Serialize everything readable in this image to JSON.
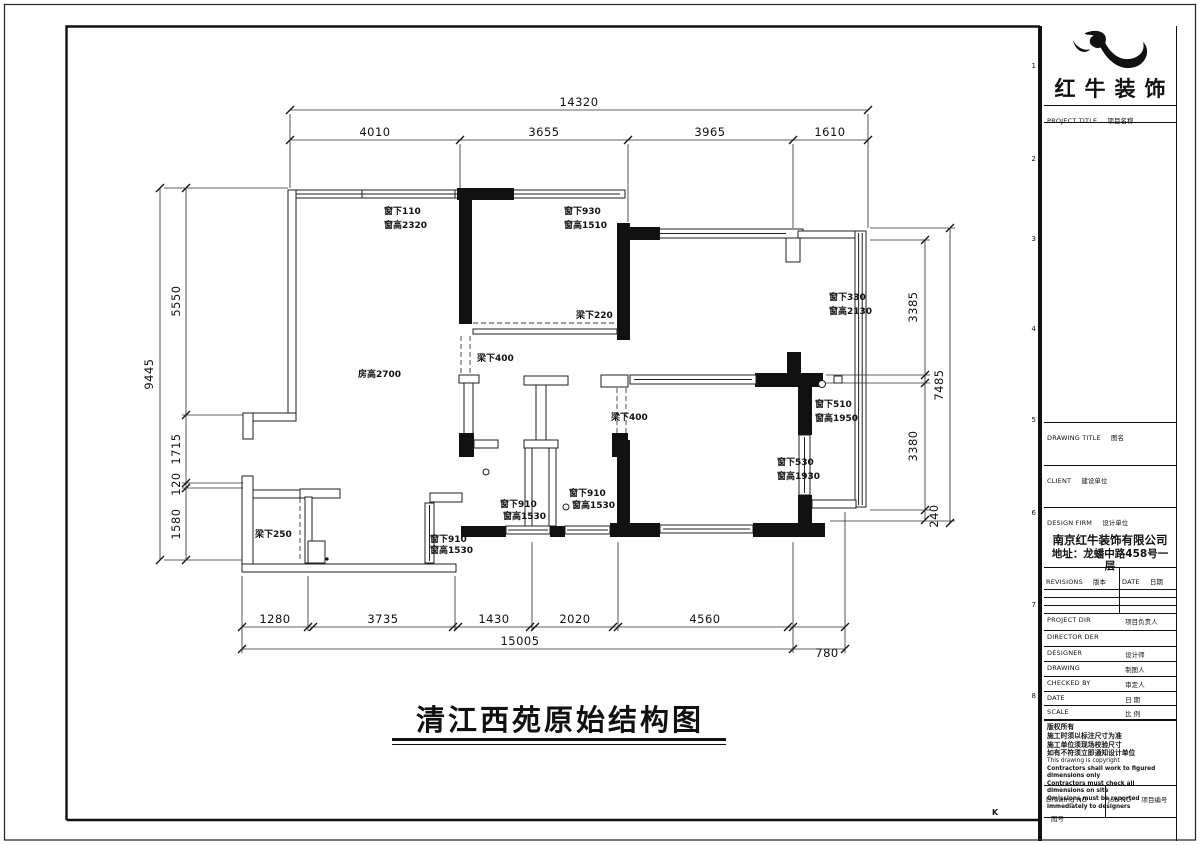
{
  "page": {
    "main_title": "清江西苑原始结构图",
    "corner_mark": "K",
    "grid_numbers": [
      "1",
      "2",
      "3",
      "4",
      "5",
      "6",
      "7",
      "8"
    ]
  },
  "title_block": {
    "logo_text": "红牛装饰",
    "project_title": {
      "en": "PROJECT TITLE",
      "cn": "项目名称"
    },
    "drawing_title": {
      "en": "DRAWING TITLE",
      "cn": "图名"
    },
    "client": {
      "en": "CLIENT",
      "cn": "建设单位"
    },
    "design_firm": {
      "en": "DESIGN FIRM",
      "cn": "设计单位"
    },
    "firm_name": "南京红牛装饰有限公司",
    "firm_address": "地址：龙蟠中路458号一层",
    "revisions": {
      "en": "REVISIONS",
      "cn": "版本"
    },
    "date_col": {
      "en": "DATE",
      "cn": "日期"
    },
    "project_dir": {
      "en": "PROJECT DIR",
      "cn": "项目负责人"
    },
    "director": {
      "en": "DIRECTOR DER",
      "cn": ""
    },
    "designer": {
      "en": "DESIGNER",
      "cn": "设计师"
    },
    "drawing": {
      "en": "DRAWING",
      "cn": "制图人"
    },
    "checked_by": {
      "en": "CHECKED BY",
      "cn": "审定人"
    },
    "date_row": {
      "en": "DATE",
      "cn": "日 期"
    },
    "scale": {
      "en": "SCALE",
      "cn": "比 例"
    },
    "notes_cn": [
      "版权所有",
      "施工时须以标注尺寸为准",
      "施工单位须现场校验尺寸",
      "如有不符须立即通知设计单位"
    ],
    "notes_en": [
      "This drawing is copyright"
    ],
    "notes_en_bold": [
      "Contractors shall work to figured dimensions only",
      "Contractors must check all dimensions on site",
      "Omissions must be reported immediately to designers"
    ],
    "drawing_no": {
      "en": "Drawing NO",
      "cn": "图号"
    },
    "job_no": {
      "en": "Job NO",
      "cn": "项目编号"
    }
  },
  "plan": {
    "annotations": [
      {
        "t": "窗下110",
        "x": 384,
        "y": 214
      },
      {
        "t": "窗高2320",
        "x": 384,
        "y": 228
      },
      {
        "t": "窗下930",
        "x": 564,
        "y": 214
      },
      {
        "t": "窗高1510",
        "x": 564,
        "y": 228
      },
      {
        "t": "梁下220",
        "x": 576,
        "y": 318
      },
      {
        "t": "梁下400",
        "x": 477,
        "y": 361
      },
      {
        "t": "房高2700",
        "x": 358,
        "y": 377
      },
      {
        "t": "窗下330",
        "x": 829,
        "y": 300
      },
      {
        "t": "窗高2130",
        "x": 829,
        "y": 314
      },
      {
        "t": "窗下510",
        "x": 815,
        "y": 407
      },
      {
        "t": "窗高1950",
        "x": 815,
        "y": 421
      },
      {
        "t": "窗下530",
        "x": 777,
        "y": 465
      },
      {
        "t": "窗高1930",
        "x": 777,
        "y": 479
      },
      {
        "t": "梁下400",
        "x": 611,
        "y": 420
      },
      {
        "t": "窗下910",
        "x": 500,
        "y": 507
      },
      {
        "t": "窗高1530",
        "x": 503,
        "y": 519
      },
      {
        "t": "窗下910",
        "x": 569,
        "y": 496
      },
      {
        "t": "窗高1530",
        "x": 572,
        "y": 508
      },
      {
        "t": "窗下910",
        "x": 430,
        "y": 542
      },
      {
        "t": "窗高1530",
        "x": 430,
        "y": 553
      },
      {
        "t": "梁下250",
        "x": 255,
        "y": 537
      }
    ],
    "dimensions": [
      {
        "t": "14320",
        "x": 579,
        "y": 106
      },
      {
        "t": "4010",
        "x": 375,
        "y": 136
      },
      {
        "t": "3655",
        "x": 544,
        "y": 136
      },
      {
        "t": "3965",
        "x": 710,
        "y": 136
      },
      {
        "t": "1610",
        "x": 830,
        "y": 136
      },
      {
        "t": "9445",
        "x": 153,
        "y": 374,
        "r": -90
      },
      {
        "t": "5550",
        "x": 180,
        "y": 301,
        "r": -90
      },
      {
        "t": "1715",
        "x": 180,
        "y": 449,
        "r": -90
      },
      {
        "t": "120",
        "x": 180,
        "y": 484,
        "r": -90
      },
      {
        "t": "1580",
        "x": 180,
        "y": 524,
        "r": -90
      },
      {
        "t": "3385",
        "x": 917,
        "y": 307,
        "r": -90
      },
      {
        "t": "7485",
        "x": 943,
        "y": 385,
        "r": -90
      },
      {
        "t": "3380",
        "x": 917,
        "y": 446,
        "r": -90
      },
      {
        "t": "240",
        "x": 938,
        "y": 516,
        "r": -90
      },
      {
        "t": "1280",
        "x": 275,
        "y": 623
      },
      {
        "t": "3735",
        "x": 383,
        "y": 623
      },
      {
        "t": "1430",
        "x": 494,
        "y": 623
      },
      {
        "t": "2020",
        "x": 575,
        "y": 623
      },
      {
        "t": "4560",
        "x": 705,
        "y": 623
      },
      {
        "t": "15005",
        "x": 520,
        "y": 645
      },
      {
        "t": "780",
        "x": 827,
        "y": 657
      }
    ]
  }
}
